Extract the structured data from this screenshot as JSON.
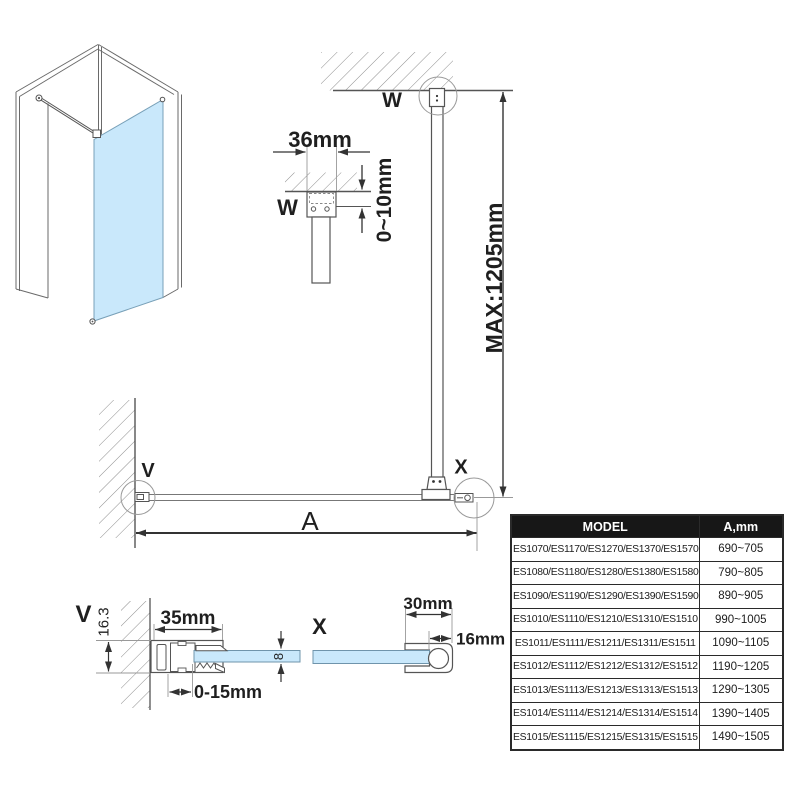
{
  "colors": {
    "glass": "#c9e8fb",
    "glass_edge": "#6f94ab",
    "line": "#555555",
    "dim": "#333333",
    "construction": "#9a9a9a",
    "table_header_bg": "#171717",
    "table_header_text": "#ffffff",
    "table_border": "#2a2a2a"
  },
  "details": {
    "wall_mount_w": {
      "label": "W",
      "bar_width": "36mm",
      "ceiling_gap": "0~10mm"
    },
    "elevation": {
      "callout_w": "W",
      "callout_v": "V",
      "callout_x": "X",
      "max_height": "MAX:1205mm",
      "width_label": "A"
    },
    "wall_profile_v": {
      "label": "V",
      "profile_depth": "16.3",
      "profile_width": "35mm",
      "glass_thickness": "8",
      "adjustment_range": "0-15mm"
    },
    "bar_holder_x": {
      "label": "X",
      "holder_width": "30mm",
      "bar_offset": "16mm"
    }
  },
  "table": {
    "headers": [
      "MODEL",
      "A,mm"
    ],
    "rows": [
      {
        "model": "ES1070/ES1170/ES1270/ES1370/ES1570",
        "a_mm": "690~705"
      },
      {
        "model": "ES1080/ES1180/ES1280/ES1380/ES1580",
        "a_mm": "790~805"
      },
      {
        "model": "ES1090/ES1190/ES1290/ES1390/ES1590",
        "a_mm": "890~905"
      },
      {
        "model": "ES1010/ES1110/ES1210/ES1310/ES1510",
        "a_mm": "990~1005"
      },
      {
        "model": "ES1011/ES1111/ES1211/ES1311/ES1511",
        "a_mm": "1090~1105"
      },
      {
        "model": "ES1012/ES1112/ES1212/ES1312/ES1512",
        "a_mm": "1190~1205"
      },
      {
        "model": "ES1013/ES1113/ES1213/ES1313/ES1513",
        "a_mm": "1290~1305"
      },
      {
        "model": "ES1014/ES1114/ES1214/ES1314/ES1514",
        "a_mm": "1390~1405"
      },
      {
        "model": "ES1015/ES1115/ES1215/ES1315/ES1515",
        "a_mm": "1490~1505"
      }
    ]
  }
}
